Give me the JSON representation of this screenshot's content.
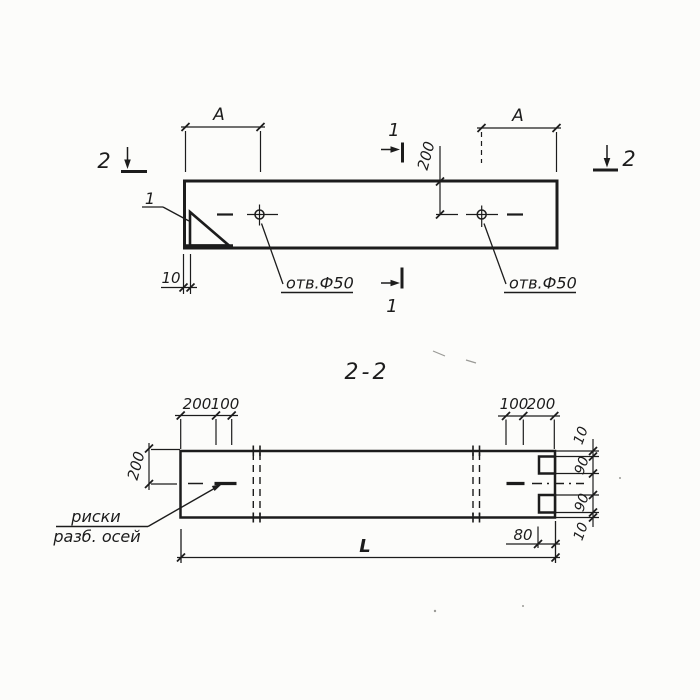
{
  "colors": {
    "ink": "#1c1c1c",
    "paper": "#fcfcfa"
  },
  "plan": {
    "cut2_left": "2",
    "cut2_right": "2",
    "cut1_top": "1",
    "cut1_bottom": "1",
    "dim_a_left": "A",
    "dim_a_right": "A",
    "dim_200": "200",
    "dim_10": "10",
    "detail_ref": "1",
    "hole_left_label": "отв.Ф50",
    "hole_right_label": "отв.Ф50"
  },
  "section": {
    "title": "2-2",
    "dim_tl_200": "200",
    "dim_tl_100": "100",
    "dim_tr_100": "100",
    "dim_tr_200": "200",
    "dim_left_200": "200",
    "dim_right_10_top": "10",
    "dim_right_90_top": "90",
    "dim_right_90_bottom": "90",
    "dim_right_10_bottom": "10",
    "dim_80": "80",
    "dim_length": "L",
    "axis_note_line1": "риски",
    "axis_note_line2": "разб. осей"
  }
}
